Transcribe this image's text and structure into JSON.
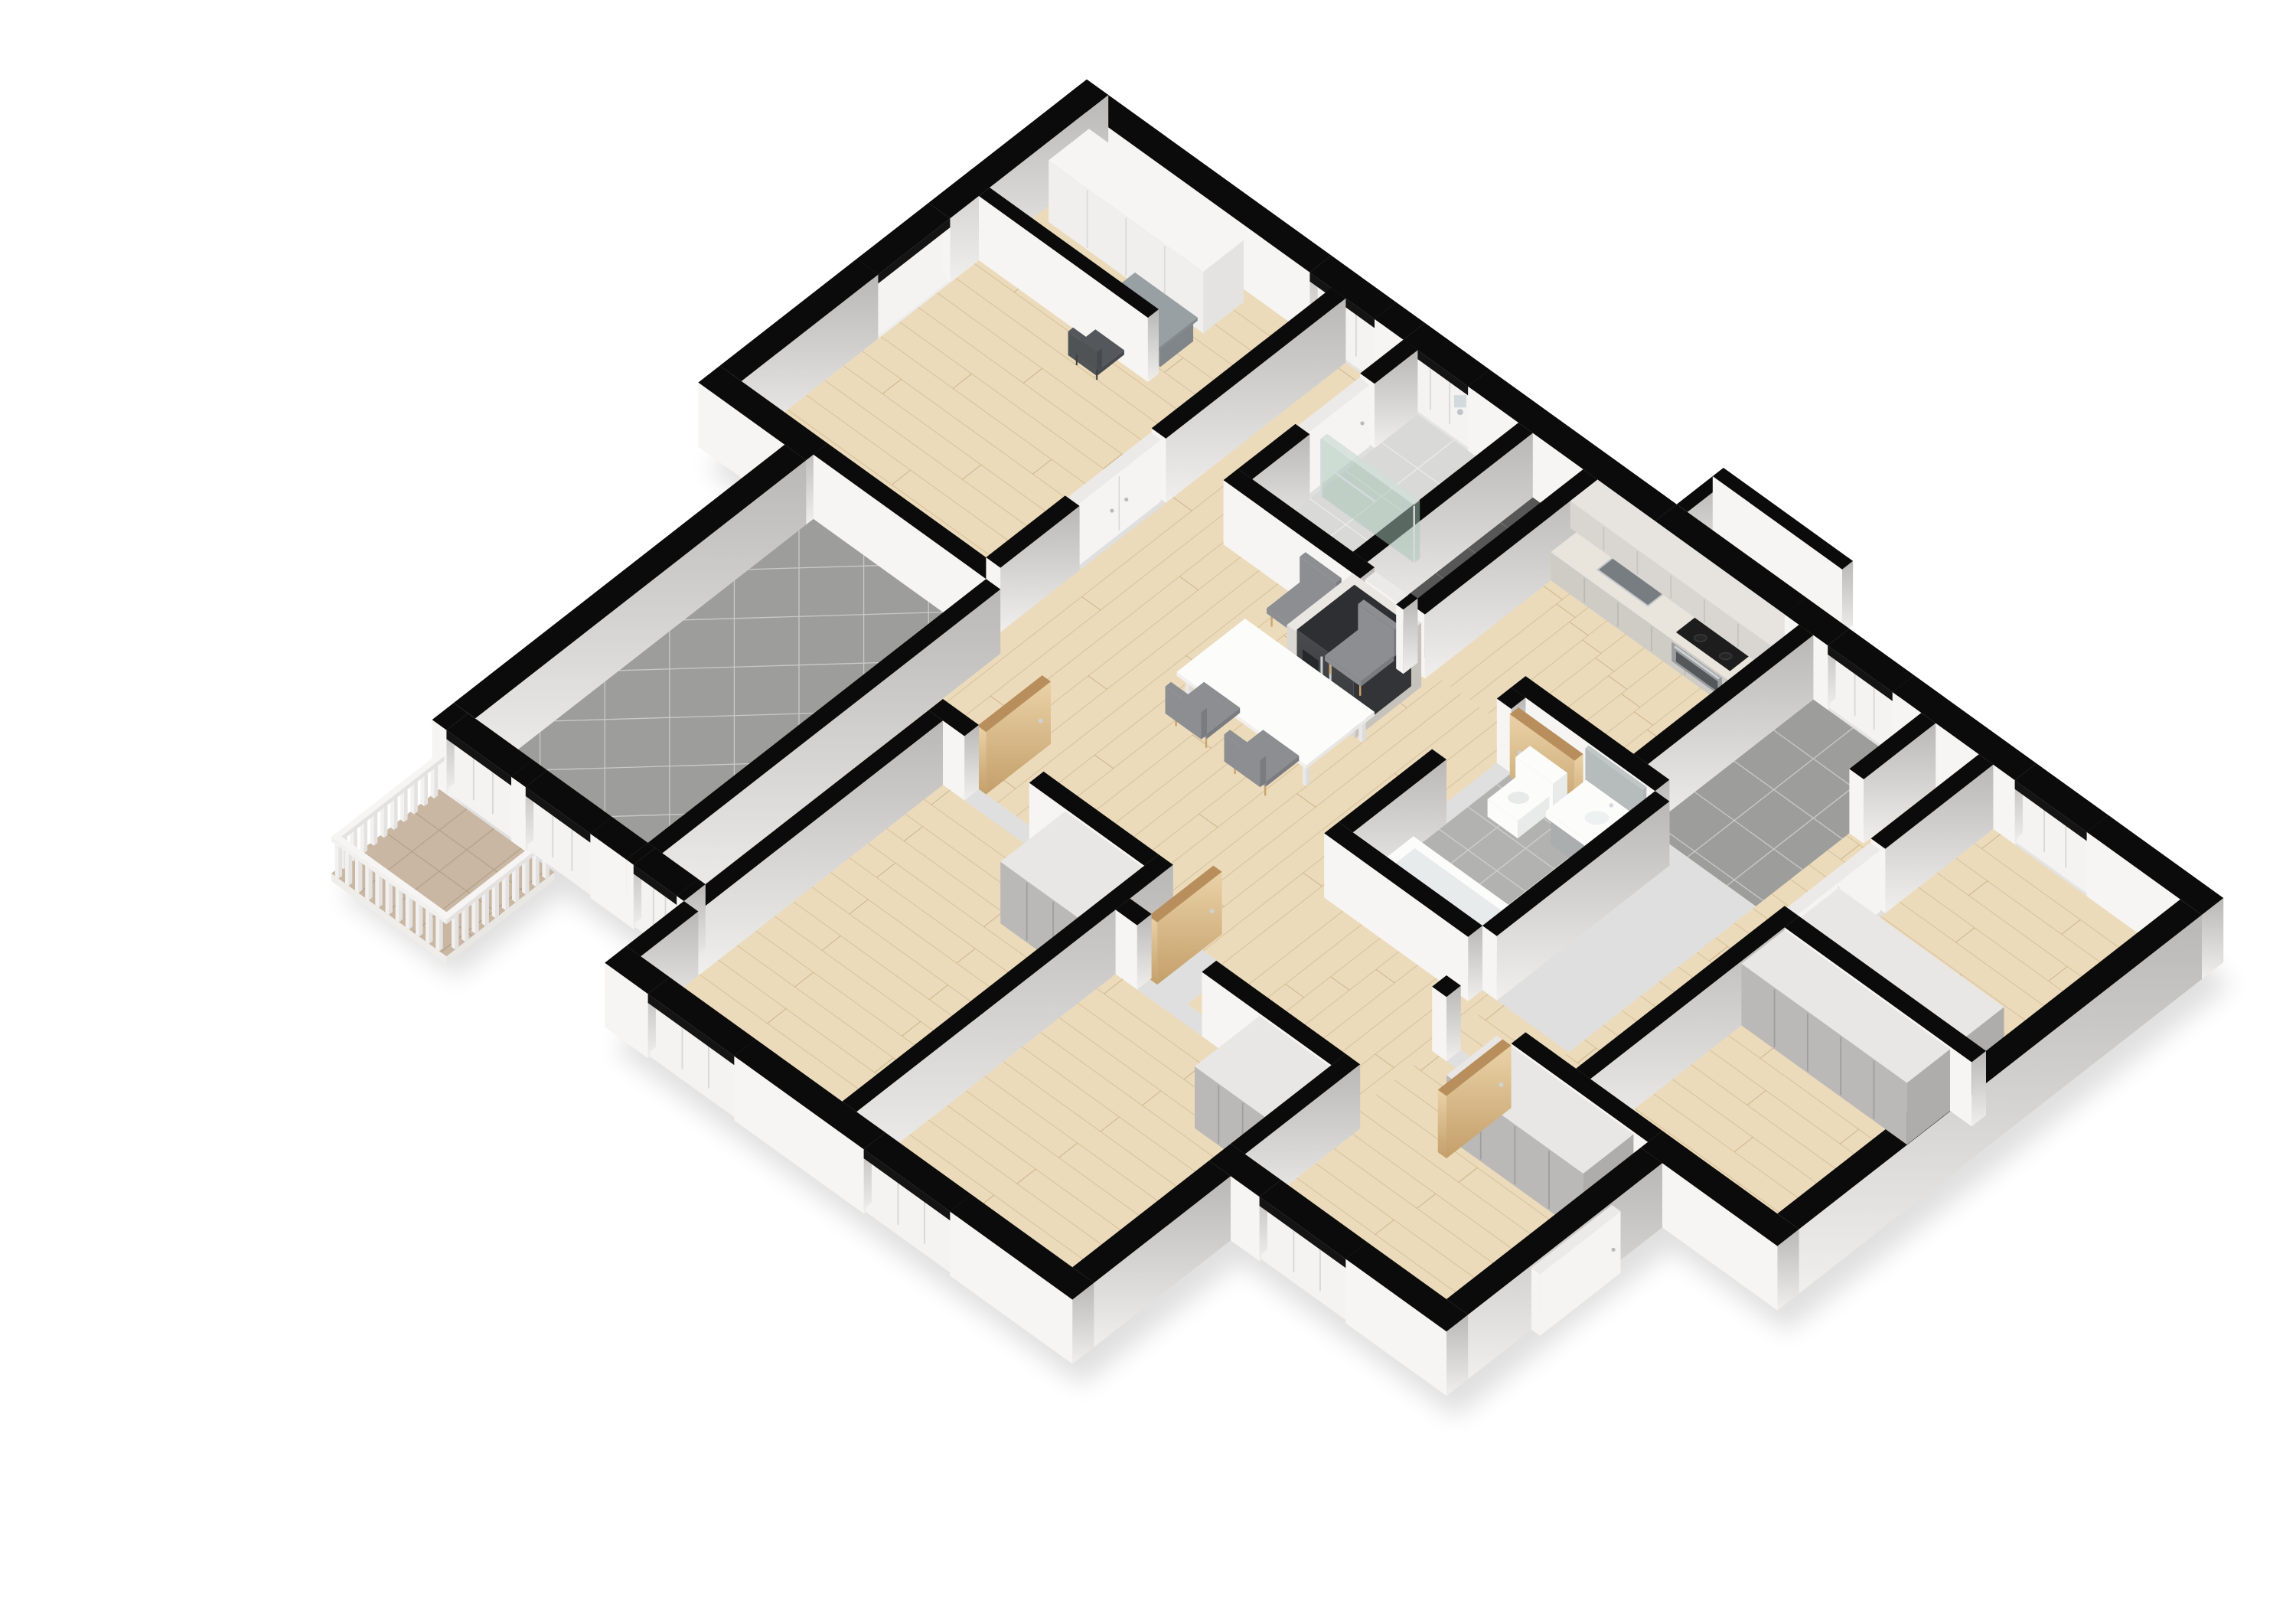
{
  "palette": {
    "bg": "#ffffff",
    "wall_top": "#0b0b0b",
    "face_y": "#f6f5f3",
    "white_face": "#f4f3f1",
    "wood_floor": "#ecdbbb",
    "plank_line": "#d8c29c",
    "plank_tick": "#cdb38a",
    "tile_gray": "#9d9d9b",
    "tile_gray_grout": "#c9c9c7",
    "tile_bath": "#b2b2b0",
    "tile_bath_grout": "#cfcfcd",
    "tile_shower": "#d9d9d7",
    "tile_shower_grout": "#ebebe9",
    "tile_dark": "#575757",
    "tile_dark_grout": "#6e6e6e",
    "balcony_tile": "#c9b7a3",
    "balcony_grout": "#b5a28b",
    "wood_door_top": "#b88f5c",
    "white_door": "#f5f4f2",
    "seam": "#d8d7d5",
    "wardrobe_panel": "#bab9b7",
    "wardrobe_seam": "#9f9e9c",
    "wardrobe_top": "#e8e7e5",
    "white_wardrobe": "#f0efed",
    "white_wardrobe_seam": "#dcdbd9",
    "counter_top": "#e9e4dc",
    "cab_face": "#cfccc6",
    "upper_face": "#d9d6d1",
    "upper_top": "#e7e4e0",
    "mosaic": "#a8a699",
    "mosaic_dark": "#90907e",
    "mosaic_light": "#c6c4b6",
    "steel": "#c3c8cc",
    "sink_basin": "#787d81",
    "cooktop": "#1d1d1d",
    "burner": "#3a3a3a",
    "oven_face": "#9a9da0",
    "fridge_top": "#2e2f32",
    "handle_chrome": "#cdd1d4",
    "fixture": "#fcfcfb",
    "fixture_shade": "#e9ebeb",
    "glass": "rgba(168,198,182,0.5)",
    "chrome": "#d3dadd",
    "seat_gray": "#8d8e92",
    "seat_dark": "#7b7c80",
    "leg_tan": "#c9a46e",
    "desk_top": "#99a0a3",
    "desk_chair": "#54575b",
    "shadow": "rgba(0,0,0,0.12)"
  },
  "projection": {
    "s": 94,
    "hs": 84,
    "ox": 1420,
    "oy": 230,
    "ax": 0.72,
    "by": 0.78
  },
  "scene": {
    "silhouette": [
      [
        -0.3,
        -0.3
      ],
      [
        15.5,
        -0.3
      ],
      [
        15.5,
        5.9
      ],
      [
        13.9,
        5.9
      ],
      [
        13.9,
        8.9
      ],
      [
        10.9,
        8.9
      ],
      [
        10.9,
        11.1
      ],
      [
        4.4,
        11.1
      ],
      [
        4.4,
        10.0
      ],
      [
        2.6,
        10.0
      ],
      [
        2.6,
        11.5
      ],
      [
        1.0,
        11.5
      ],
      [
        1.0,
        10.0
      ],
      [
        0.9,
        10.0
      ],
      [
        0.9,
        5.1
      ],
      [
        -0.3,
        5.1
      ]
    ],
    "floors": [
      {
        "name": "bedroom-1-floor",
        "rect": [
          0,
          0,
          3.4,
          4.8
        ],
        "style": "wood",
        "dir": "x"
      },
      {
        "name": "hall-top-floor",
        "rect": [
          3.6,
          0,
          4.4,
          2.3
        ],
        "style": "wood",
        "dir": "y"
      },
      {
        "name": "living-dining-floor",
        "rect": [
          3.6,
          2.3,
          8.4,
          6.4
        ],
        "style": "wood",
        "dir": "y"
      },
      {
        "name": "living-left-floor",
        "rect": [
          3.8,
          6.4,
          4.4,
          9.7
        ],
        "style": "wood",
        "dir": "y"
      },
      {
        "name": "kitchen-floor",
        "rect": [
          7.1,
          0.65,
          9.9,
          2.3
        ],
        "style": "wood",
        "dir": "y"
      },
      {
        "name": "corridor-mid-floor",
        "rect": [
          8.4,
          4.9,
          10.6,
          7.0
        ],
        "style": "wood",
        "dir": "y"
      },
      {
        "name": "hall-right-floor",
        "rect": [
          11.6,
          0,
          12.4,
          5.6
        ],
        "style": "wood",
        "dir": "x"
      },
      {
        "name": "hall-right-w-floor",
        "rect": [
          10.6,
          4.9,
          11.6,
          5.6
        ],
        "style": "wood",
        "dir": "x"
      },
      {
        "name": "bedroom-2-floor",
        "rect": [
          4.6,
          6.6,
          7.4,
          10.8
        ],
        "style": "wood",
        "dir": "x"
      },
      {
        "name": "bedroom-3-floor",
        "rect": [
          7.6,
          7.2,
          10.6,
          10.8
        ],
        "style": "wood",
        "dir": "x"
      },
      {
        "name": "bedroom-4-floor",
        "rect": [
          10.6,
          5.8,
          13.6,
          8.6
        ],
        "style": "wood",
        "dir": "x"
      },
      {
        "name": "room-right-1-floor",
        "rect": [
          12.6,
          0,
          15.2,
          2.7
        ],
        "style": "wood",
        "dir": "x"
      },
      {
        "name": "room-right-2-floor",
        "rect": [
          12.6,
          2.9,
          15.2,
          5.6
        ],
        "style": "wood",
        "dir": "x"
      },
      {
        "name": "entry-floor",
        "rect": [
          10.1,
          0,
          11.6,
          2.3
        ],
        "style": "tileGray"
      },
      {
        "name": "shower-room-floor",
        "rect": [
          4.6,
          0,
          6.0,
          2.3
        ],
        "style": "tileShower"
      },
      {
        "name": "wc-floor",
        "rect": [
          6.2,
          0,
          6.9,
          2.3
        ],
        "style": "tileDark"
      },
      {
        "name": "bathroom-floor",
        "rect": [
          8.6,
          2.5,
          10.4,
          4.9
        ],
        "style": "tileBath"
      },
      {
        "name": "terrace-floor",
        "rect": [
          1.2,
          5.0,
          3.6,
          9.7
        ],
        "style": "tileDiag"
      }
    ],
    "walls": [
      {
        "name": "ne-wall-1",
        "rect": [
          -0.3,
          -0.3,
          3.1,
          0
        ]
      },
      {
        "name": "ne-wall-2",
        "rect": [
          4.0,
          -0.3,
          4.4,
          0
        ]
      },
      {
        "name": "ne-wall-3",
        "rect": [
          5.3,
          -0.3,
          7.9,
          0
        ]
      },
      {
        "name": "ne-wall-4",
        "rect": [
          9.7,
          -0.3,
          10.3,
          0
        ]
      },
      {
        "name": "ne-wall-5",
        "rect": [
          11.2,
          -0.3,
          12.9,
          0
        ]
      },
      {
        "name": "ne-wall-6",
        "rect": [
          13.9,
          -0.3,
          15.5,
          0
        ]
      },
      {
        "name": "nw-wall-1",
        "rect": [
          -0.3,
          -0.3,
          0,
          1.9
        ]
      },
      {
        "name": "nw-wall-2",
        "rect": [
          -0.3,
          2.9,
          0,
          4.8
        ]
      },
      {
        "name": "w-step-wall",
        "rect": [
          -0.3,
          4.8,
          1.2,
          5.1
        ]
      },
      {
        "name": "terrace-w-wall",
        "rect": [
          0.9,
          5.1,
          1.2,
          9.7
        ]
      },
      {
        "name": "terrace-sw-wall-1",
        "rect": [
          0.9,
          9.7,
          1.1,
          10.0
        ]
      },
      {
        "name": "terrace-sw-wall-2",
        "rect": [
          2.0,
          9.7,
          2.2,
          10.0
        ]
      },
      {
        "name": "terrace-sw-wall-3",
        "rect": [
          3.1,
          9.7,
          3.6,
          10.0
        ]
      },
      {
        "name": "terrace-e-wall",
        "rect": [
          3.6,
          5.0,
          3.8,
          9.7
        ]
      },
      {
        "name": "living-sw-wall-1",
        "rect": [
          3.6,
          9.7,
          3.7,
          10.0
        ]
      },
      {
        "name": "living-sw-wall-2",
        "rect": [
          4.3,
          9.7,
          4.4,
          10.0
        ]
      },
      {
        "name": "sw-wall-1",
        "rect": [
          4.4,
          10.8,
          5.0,
          11.1
        ]
      },
      {
        "name": "sw-wall-2",
        "rect": [
          6.2,
          10.8,
          8.0,
          11.1
        ]
      },
      {
        "name": "sw-wall-3",
        "rect": [
          9.2,
          10.8,
          10.9,
          11.1
        ]
      },
      {
        "name": "w-b2-ext-wall",
        "rect": [
          4.4,
          10.0,
          4.6,
          10.8
        ]
      },
      {
        "name": "se-wall-1",
        "rect": [
          13.6,
          5.6,
          15.5,
          5.9
        ]
      },
      {
        "name": "se-wall-2",
        "rect": [
          13.6,
          5.9,
          13.9,
          8.6
        ]
      },
      {
        "name": "se-wall-3",
        "rect": [
          10.6,
          8.6,
          11.3,
          8.9
        ]
      },
      {
        "name": "se-wall-4",
        "rect": [
          12.5,
          8.6,
          13.9,
          8.9
        ]
      },
      {
        "name": "se-wall-5",
        "rect": [
          10.6,
          8.9,
          10.9,
          10.8
        ]
      },
      {
        "name": "e-wall",
        "rect": [
          15.2,
          0,
          15.5,
          5.6
        ]
      },
      {
        "name": "bedroom1-e-wall-1",
        "rect": [
          3.4,
          0,
          3.6,
          2.5
        ]
      },
      {
        "name": "bedroom1-e-wall-2",
        "rect": [
          3.4,
          3.7,
          3.6,
          4.8
        ]
      },
      {
        "name": "nook-wall",
        "rect": [
          0,
          1.35,
          2.35,
          1.5
        ]
      },
      {
        "name": "bedroom1-s-wall",
        "rect": [
          1.2,
          4.8,
          3.6,
          5.0
        ]
      },
      {
        "name": "shower-w-wall-1",
        "rect": [
          4.4,
          0,
          4.6,
          0.6
        ]
      },
      {
        "name": "shower-w-wall-2",
        "rect": [
          4.4,
          1.5,
          4.6,
          2.3
        ]
      },
      {
        "name": "shower-wc-wall",
        "rect": [
          6.0,
          0,
          6.2,
          2.3
        ]
      },
      {
        "name": "wc-e-wall",
        "rect": [
          6.9,
          0,
          7.1,
          2.4
        ]
      },
      {
        "name": "shower-s-wall-1",
        "rect": [
          4.4,
          2.3,
          6.3,
          2.5
        ]
      },
      {
        "name": "shower-s-wall-2",
        "rect": [
          6.8,
          2.3,
          6.9,
          2.5
        ]
      },
      {
        "name": "kitchen-entry-wall",
        "rect": [
          9.9,
          0,
          10.1,
          2.3
        ]
      },
      {
        "name": "bath-n-wall",
        "rect": [
          8.4,
          2.3,
          10.4,
          2.5
        ]
      },
      {
        "name": "bath-w-wall-1",
        "rect": [
          8.4,
          2.5,
          8.6,
          2.7
        ]
      },
      {
        "name": "bath-w-wall-2",
        "rect": [
          8.4,
          3.6,
          8.6,
          4.9
        ]
      },
      {
        "name": "bath-s-wall",
        "rect": [
          8.4,
          4.9,
          10.4,
          5.1
        ]
      },
      {
        "name": "bath-e-wall",
        "rect": [
          10.4,
          2.5,
          10.6,
          4.9
        ]
      },
      {
        "name": "entry-hall-wall",
        "rect": [
          11.6,
          0,
          11.8,
          1.0
        ]
      },
      {
        "name": "hall-e-wall-1",
        "rect": [
          12.4,
          0,
          12.6,
          1.5
        ]
      },
      {
        "name": "hall-e-wall-2",
        "rect": [
          12.4,
          2.7,
          12.6,
          5.6
        ]
      },
      {
        "name": "room-r1-s-wall",
        "rect": [
          12.6,
          2.7,
          15.2,
          2.9
        ]
      },
      {
        "name": "hall-s-wall-1",
        "rect": [
          10.6,
          5.6,
          10.8,
          5.8
        ]
      },
      {
        "name": "hall-s-wall-2",
        "rect": [
          11.7,
          5.6,
          13.6,
          5.8
        ]
      },
      {
        "name": "b2-n-wall-1",
        "rect": [
          4.4,
          6.4,
          4.9,
          6.6
        ]
      },
      {
        "name": "b2-n-wall-2",
        "rect": [
          5.8,
          6.4,
          7.4,
          6.6
        ]
      },
      {
        "name": "b2-e-wall",
        "rect": [
          7.4,
          6.4,
          7.6,
          10.8
        ]
      },
      {
        "name": "b2-w-wall",
        "rect": [
          4.4,
          6.6,
          4.6,
          10.0
        ]
      },
      {
        "name": "b3-n-wall-1",
        "rect": [
          7.6,
          7.0,
          7.9,
          7.2
        ]
      },
      {
        "name": "b3-n-wall-2",
        "rect": [
          8.8,
          7.0,
          10.6,
          7.2
        ]
      },
      {
        "name": "b3-e-wall",
        "rect": [
          10.6,
          7.0,
          10.8,
          8.6
        ]
      }
    ],
    "windows": [
      {
        "name": "window-ne-1",
        "orient": "ne",
        "a1": 3.1,
        "a2": 4.0
      },
      {
        "name": "window-ne-2",
        "orient": "ne",
        "a1": 4.4,
        "a2": 5.3
      },
      {
        "name": "window-ne-3",
        "orient": "ne",
        "a1": 10.3,
        "a2": 11.2
      },
      {
        "name": "window-ne-4",
        "orient": "ne",
        "a1": 12.9,
        "a2": 13.9
      },
      {
        "name": "window-nw-1",
        "orient": "nw",
        "a1": 1.9,
        "a2": 2.9
      },
      {
        "name": "window-sw-1",
        "orient": "swm",
        "a1": 5.0,
        "a2": 6.2
      },
      {
        "name": "window-sw-2",
        "orient": "swm",
        "a1": 8.0,
        "a2": 9.2
      },
      {
        "name": "window-se-1",
        "orient": "se",
        "a1": 11.3,
        "a2": 12.5
      },
      {
        "name": "balcony-door",
        "orient": "tsw",
        "a1": 1.1,
        "a2": 2.0
      },
      {
        "name": "terrace-window",
        "orient": "tsw",
        "a1": 2.2,
        "a2": 3.1
      },
      {
        "name": "living-sw-window",
        "orient": "tsw",
        "a1": 3.7,
        "a2": 4.3
      }
    ],
    "bay": {
      "name": "kitchen-bay-window",
      "x1": 7.9,
      "x2": 9.7
    },
    "doors": [
      {
        "name": "bathroom-door",
        "kind": "wood",
        "rect": [
          8.62,
          2.62,
          9.52,
          2.74
        ]
      },
      {
        "name": "bedroom2-door",
        "kind": "wood",
        "rect": [
          4.88,
          5.5,
          5.0,
          6.4
        ]
      },
      {
        "name": "bedroom3-door",
        "kind": "wood",
        "rect": [
          7.88,
          6.12,
          8.0,
          7.02
        ]
      },
      {
        "name": "bedroom4-door",
        "kind": "wood",
        "rect": [
          11.58,
          5.8,
          11.7,
          6.7
        ]
      },
      {
        "name": "wc-door",
        "kind": "white",
        "rect": [
          6.32,
          2.31,
          6.78,
          2.45
        ]
      },
      {
        "name": "shower-door",
        "kind": "white",
        "rect": [
          4.41,
          0.62,
          4.55,
          1.48
        ]
      },
      {
        "name": "bedroom1-double-doors",
        "kind": "flush2",
        "rect": [
          3.41,
          2.52,
          3.55,
          3.68
        ]
      },
      {
        "name": "hall-closet-doors",
        "kind": "flush2",
        "rect": [
          12.41,
          1.52,
          12.55,
          2.68
        ]
      },
      {
        "name": "exterior-open-door",
        "kind": "white",
        "rect": [
          13.9,
          6.6,
          14.02,
          7.72
        ]
      }
    ],
    "furniture": [
      {
        "name": "bedroom2-wardrobe",
        "kind": "wardrobe",
        "rect": [
          6.3,
          6.6,
          7.4,
          7.5
        ],
        "seams": 3
      },
      {
        "name": "bedroom3-wardrobe",
        "kind": "wardrobe",
        "rect": [
          9.6,
          7.2,
          10.6,
          8.1
        ],
        "seams": 3
      },
      {
        "name": "bedroom4-wardrobe",
        "kind": "wardrobe",
        "rect": [
          11.5,
          5.8,
          13.4,
          6.5
        ],
        "seams": 4
      },
      {
        "name": "room-r1-wardrobe",
        "kind": "wardrobe",
        "rect": [
          12.6,
          2.15,
          14.9,
          2.75
        ],
        "seams": 5
      },
      {
        "name": "room-r2-wardrobe",
        "kind": "wardrobe",
        "rect": [
          12.6,
          2.9,
          14.9,
          3.5
        ],
        "seams": 5
      },
      {
        "name": "nook-wardrobe",
        "kind": "wardrobeWhite",
        "rect": [
          0.15,
          0.12,
          2.3,
          0.68
        ],
        "seams": 4
      },
      {
        "name": "desk",
        "kind": "desk",
        "rect": [
          1.45,
          0.78,
          2.32,
          1.32
        ]
      },
      {
        "name": "desk-chair",
        "kind": "deskChair",
        "rect": [
          1.62,
          1.5,
          2.02,
          1.88
        ]
      },
      {
        "name": "kitchen-counter",
        "kind": "counterSet",
        "counter": [
          7.1,
          0,
          9.9,
          0.65
        ],
        "uppers": [
          7.1,
          0,
          9.9,
          0.38
        ],
        "sink": [
          7.6,
          0.14,
          8.3,
          0.5
        ],
        "cooktop": [
          8.75,
          0.12,
          9.5,
          0.56
        ]
      },
      {
        "name": "fridge",
        "kind": "fridge",
        "cab": [
          6.2,
          2.5,
          7.15,
          3.42
        ],
        "unit": [
          6.28,
          2.56,
          7.07,
          3.36
        ]
      },
      {
        "name": "dining-table",
        "kind": "table",
        "rect": [
          5.5,
          3.3,
          7.3,
          4.25
        ]
      },
      {
        "name": "dining-chair-1",
        "kind": "chair",
        "cx": 5.72,
        "cy": 2.74,
        "face": 1
      },
      {
        "name": "dining-chair-2",
        "kind": "chair",
        "cx": 6.58,
        "cy": 2.79,
        "face": 1
      },
      {
        "name": "dining-chair-3",
        "kind": "chair",
        "cx": 5.95,
        "cy": 4.3,
        "face": -1
      },
      {
        "name": "dining-chair-4",
        "kind": "chair",
        "cx": 6.82,
        "cy": 4.35,
        "face": -1
      },
      {
        "name": "toilet",
        "kind": "toilet",
        "rect": [
          8.78,
          2.62,
          9.3,
          3.26
        ]
      },
      {
        "name": "vanity-sink",
        "kind": "vanity",
        "rect": [
          9.5,
          2.56,
          10.36,
          3.12
        ]
      },
      {
        "name": "bathroom-mirror",
        "kind": "mirror",
        "rect": [
          9.5,
          2.52,
          10.3,
          2.57
        ]
      },
      {
        "name": "bathtub",
        "kind": "tub",
        "rect": [
          8.68,
          4.14,
          10.36,
          4.86
        ]
      },
      {
        "name": "shower-enclosure",
        "kind": "shower",
        "glass": [
          4.66,
          1.32,
          5.95,
          1.4
        ]
      },
      {
        "name": "balcony",
        "kind": "railingBalcony",
        "rect": [
          1.0,
          10.0,
          2.6,
          11.5
        ]
      }
    ]
  }
}
